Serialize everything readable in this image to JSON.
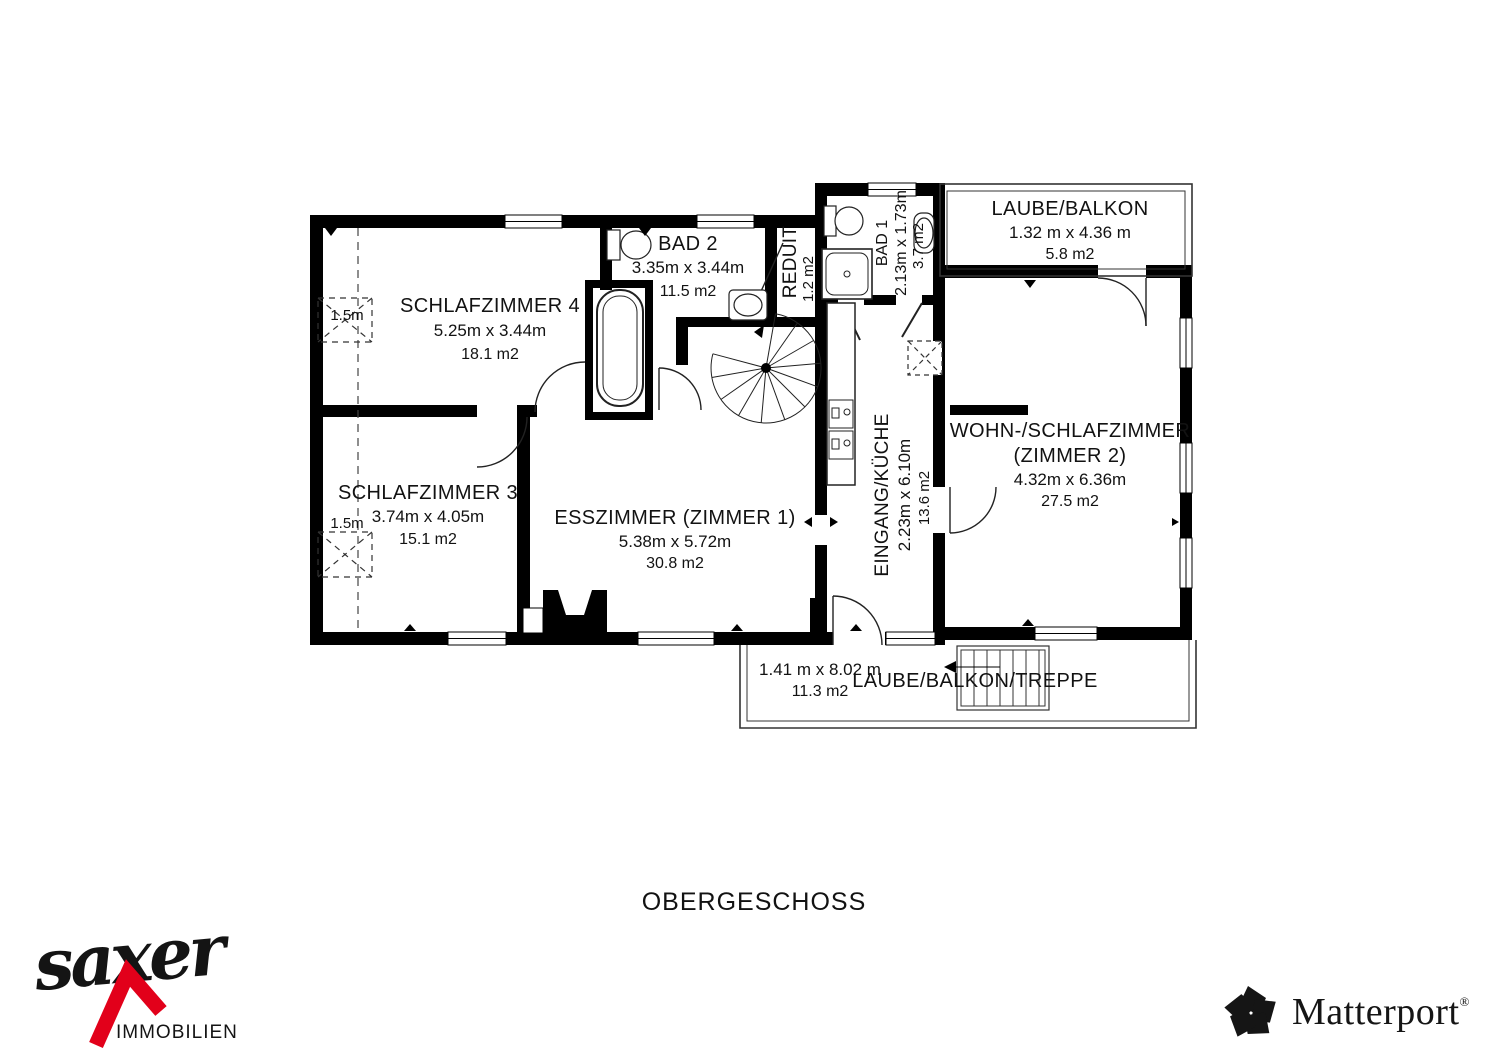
{
  "floor_title": "OBERGESCHOSS",
  "rooms": {
    "schlafzimmer4": {
      "name": "SCHLAFZIMMER 4",
      "dims": "5.25m x 3.44m",
      "area": "18.1 m2"
    },
    "bad2": {
      "name": "BAD 2",
      "dims": "3.35m x 3.44m",
      "area": "11.5 m2"
    },
    "reduit": {
      "name": "REDUIT",
      "area": "1.2 m2"
    },
    "bad1": {
      "name": "BAD 1",
      "dims": "2.13m x 1.73m",
      "area": "3.7 m2"
    },
    "laube_balkon": {
      "name": "LAUBE/BALKON",
      "dims": "1.32 m x 4.36 m",
      "area": "5.8 m2"
    },
    "schlafzimmer3": {
      "name": "SCHLAFZIMMER 3",
      "dims": "3.74m x 4.05m",
      "area": "15.1 m2"
    },
    "esszimmer": {
      "name": "ESSZIMMER (ZIMMER 1)",
      "dims": "5.38m x 5.72m",
      "area": "30.8 m2"
    },
    "eingang_kueche": {
      "name": "EINGANG/KÜCHE",
      "dims": "2.23m x 6.10m",
      "area": "13.6 m2"
    },
    "wohn_schlafzimmer": {
      "name": "WOHN-/SCHLAFZIMMER",
      "name2": "(ZIMMER 2)",
      "dims": "4.32m x 6.36m",
      "area": "27.5 m2"
    },
    "laube_treppe": {
      "name": "LAUBE/BALKON/TREPPE",
      "dims": "1.41 m x 8.02 m",
      "area": "11.3 m2"
    }
  },
  "annotations": {
    "closet_width_1": "1.5m",
    "closet_width_2": "1.5m"
  },
  "branding": {
    "agency": "saxer",
    "agency_tagline": "IMMOBILIEN",
    "scan_provider": "Matterport",
    "trademark": "®"
  },
  "colors": {
    "walls": "#000000",
    "logo_red": "#e2001a",
    "text": "#121212"
  }
}
